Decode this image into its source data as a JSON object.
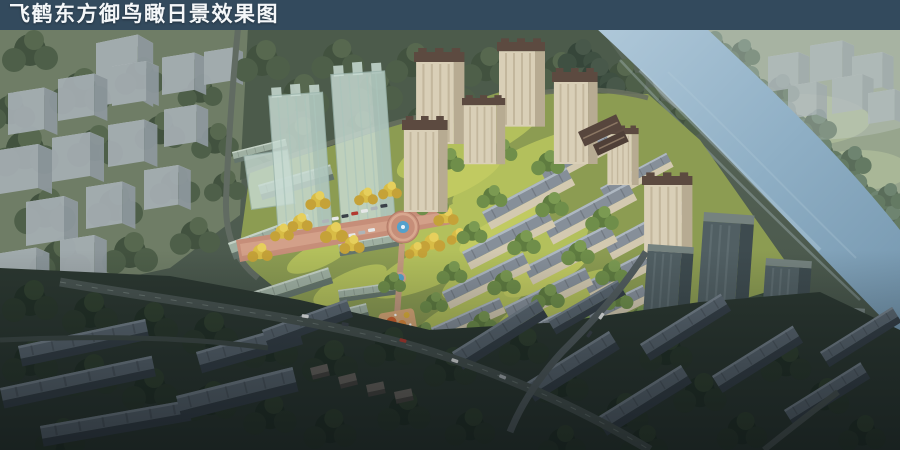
{
  "header": {
    "title": "飞鹤东方御鸟瞰日景效果图"
  },
  "palette": {
    "titlebar_bg": "#334A5D",
    "title_text": "#F4F7F9",
    "river_water": "#93B1C7",
    "forest_dark": "#46564A",
    "site_lawn": "#8C9C52",
    "tree_yellow": "#D8BC46",
    "building_tan": "#D9CFB7",
    "roof_brown": "#5C4A40",
    "glass_ghost": "#C9DCD4",
    "massing_gray": "#A6AFB4",
    "plaza_paving": "#C68E79",
    "shadow_zone": "#2B3730"
  }
}
